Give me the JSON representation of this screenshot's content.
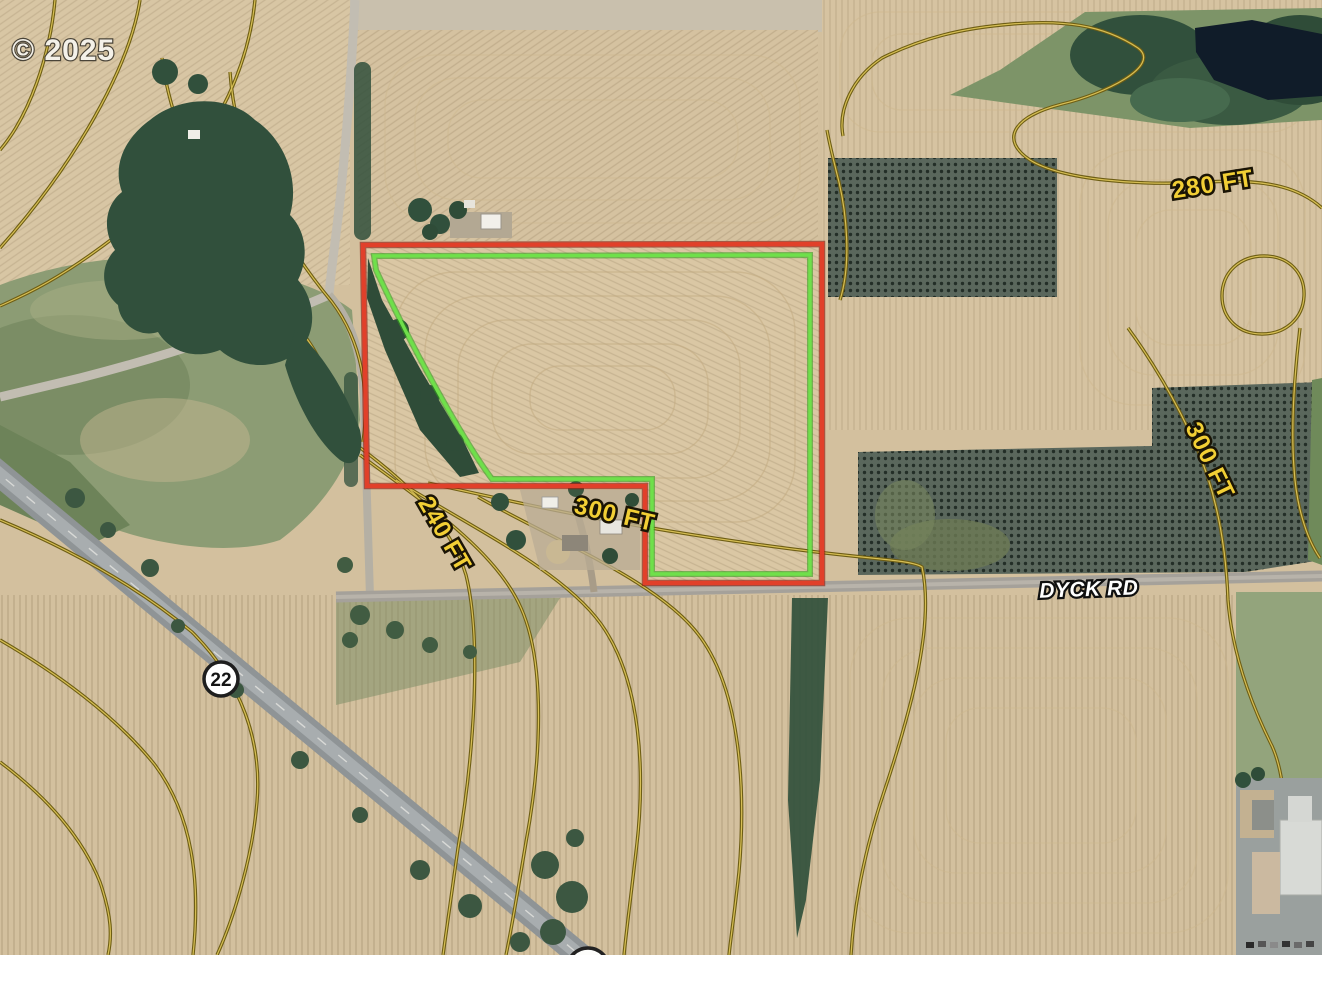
{
  "watermark": {
    "text": "© 2025"
  },
  "labels": {
    "contour": [
      {
        "id": "northeast",
        "text": "280 FT"
      },
      {
        "id": "east",
        "text": "300 FT"
      },
      {
        "id": "west",
        "text": "240 FT"
      },
      {
        "id": "center",
        "text": "300 FT"
      }
    ],
    "road": {
      "dyck": "DYCK RD"
    },
    "highway_shield": "22"
  },
  "colors": {
    "parcel_outer": "#e1402a",
    "parcel_inner": "#6fe04a",
    "contour_core": "#d7bf55",
    "contour_label": "#f2cf35",
    "field_tan": "#d3c09e",
    "trees_dark": "#31503c",
    "orchard": "#5a675c",
    "water": "#101c29",
    "road_gray": "#a5a19a",
    "highway_gray": "#8f9496"
  }
}
